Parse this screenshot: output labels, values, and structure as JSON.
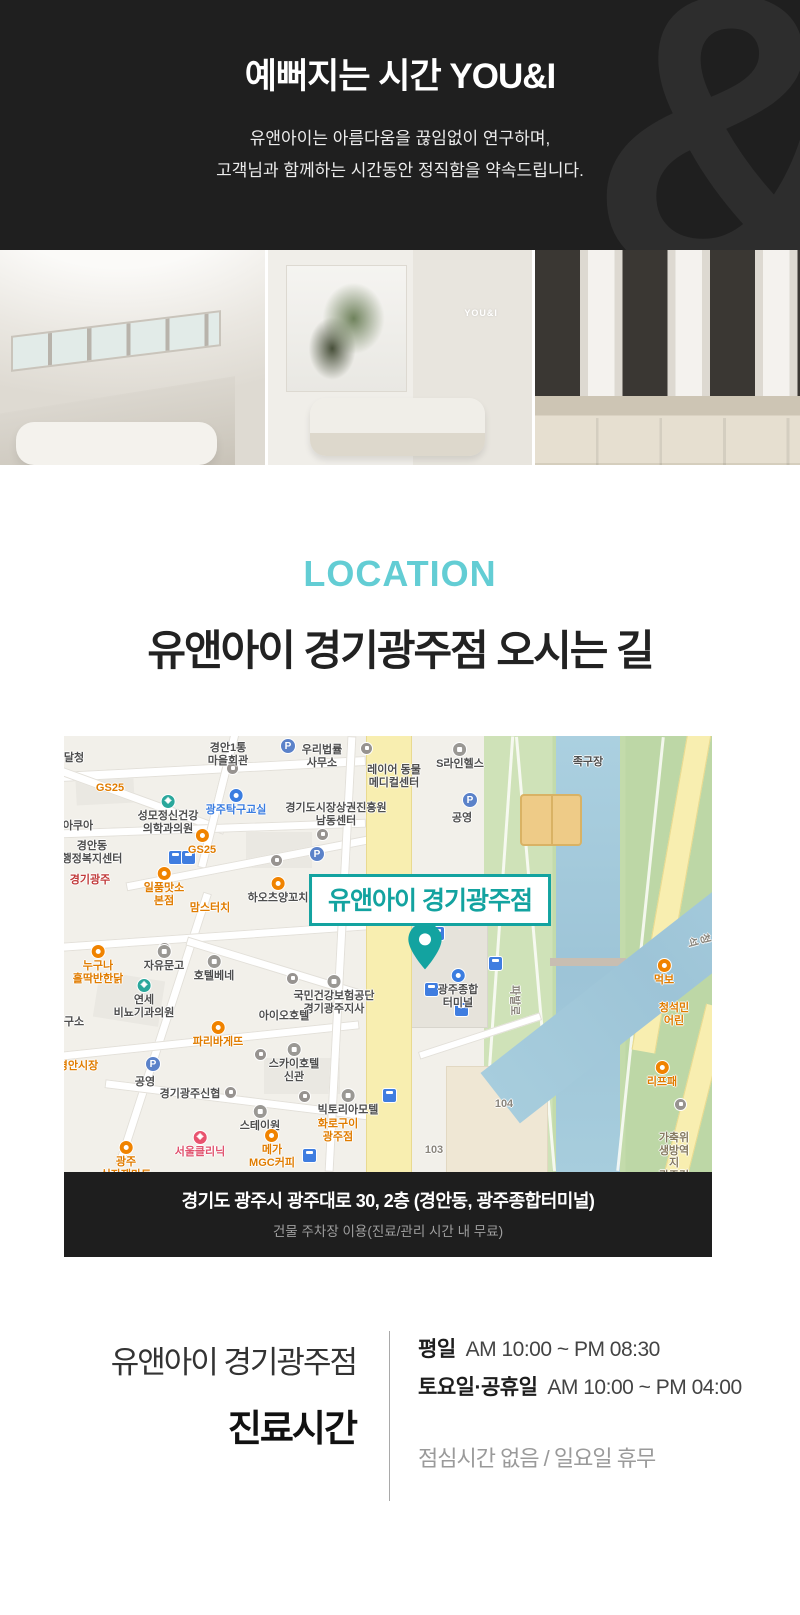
{
  "colors": {
    "accent_light": "#63cdd4",
    "accent_teal": "#13a3a0",
    "header_bg": "#1f1f1f",
    "bar_bg": "#1e1e1e"
  },
  "header": {
    "title": "예뻐지는 시간 YOU&I",
    "subtitle1": "유앤아이는 아름다움을 끊임없이 연구하며,",
    "subtitle2": "고객님과 함께하는 시간동안 정직함을 약속드립니다.",
    "watermark": "&"
  },
  "photos": {
    "sign": "YOU&I"
  },
  "location": {
    "eyebrow": "LOCATION",
    "heading": "유앤아이 경기광주점 오시는 길"
  },
  "map": {
    "callout": "유앤아이 경기광주점",
    "address": "경기도 광주시 광주대로 30, 2층 (경안동, 광주종합터미널)",
    "parking": "건물 주차장 이용(진료/관리 시간 내 무료)",
    "labels": [
      {
        "t": "달청",
        "x": 10,
        "y": 16,
        "c": "g"
      },
      {
        "t": "GS25",
        "x": 46,
        "y": 46,
        "c": "o"
      },
      {
        "t": "성모정신건강\n의학과의원",
        "x": 104,
        "y": 58,
        "c": "g",
        "ic": "h"
      },
      {
        "t": "아쿠아",
        "x": 14,
        "y": 84,
        "c": "g"
      },
      {
        "t": "경안동\n행정복지센터",
        "x": 28,
        "y": 104,
        "c": "g"
      },
      {
        "t": "경안1통\n마을회관",
        "x": 164,
        "y": 6,
        "c": "g"
      },
      {
        "t": "우리법률\n사무소",
        "x": 258,
        "y": 8,
        "c": "g"
      },
      {
        "t": "레이어 동물\n메디컬센터",
        "x": 330,
        "y": 28,
        "c": "g"
      },
      {
        "t": "S라인헬스",
        "x": 396,
        "y": 6,
        "c": "g",
        "ic": "d"
      },
      {
        "t": "광주탁구교실",
        "x": 172,
        "y": 52,
        "c": "b",
        "ic": "b"
      },
      {
        "t": "경기도시장상권진흥원\n남동센터",
        "x": 272,
        "y": 66,
        "c": "g"
      },
      {
        "t": "공영",
        "x": 398,
        "y": 76,
        "c": "g"
      },
      {
        "t": "족구장",
        "x": 524,
        "y": 20,
        "c": "g"
      },
      {
        "t": "경안천",
        "x": 608,
        "y": 10,
        "c": "river",
        "r": 52
      },
      {
        "t": "GS25",
        "x": 138,
        "y": 92,
        "c": "o",
        "ic": "o"
      },
      {
        "t": "일품맛소\n본점",
        "x": 100,
        "y": 130,
        "c": "o",
        "ic": "o"
      },
      {
        "t": "경기광주",
        "x": 26,
        "y": 138,
        "c": "r"
      },
      {
        "t": "하오츠양꼬치",
        "x": 214,
        "y": 140,
        "c": "g",
        "ic": "o"
      },
      {
        "t": "맘스터치",
        "x": 146,
        "y": 166,
        "c": "o"
      },
      {
        "t": "뚜레쥬르",
        "x": 270,
        "y": 162,
        "c": "o"
      },
      {
        "t": "이마",
        "x": 326,
        "y": 176,
        "c": "o"
      },
      {
        "t": "누구나\n홀딱반한닭",
        "x": 34,
        "y": 208,
        "c": "o",
        "ic": "o"
      },
      {
        "t": "자유문고",
        "x": 100,
        "y": 208,
        "c": "g",
        "ic": "d"
      },
      {
        "t": "호텔베네",
        "x": 150,
        "y": 218,
        "c": "g",
        "ic": "d"
      },
      {
        "t": "연세\n비뇨기과의원",
        "x": 80,
        "y": 242,
        "c": "g",
        "ic": "h"
      },
      {
        "t": "국민건강보험공단\n경기광주지사",
        "x": 270,
        "y": 238,
        "c": "g",
        "ic": "d"
      },
      {
        "t": "아이오호텔",
        "x": 220,
        "y": 274,
        "c": "g"
      },
      {
        "t": "파리바게뜨",
        "x": 154,
        "y": 284,
        "c": "o",
        "ic": "o"
      },
      {
        "t": "구소",
        "x": 10,
        "y": 280,
        "c": "g"
      },
      {
        "t": "경안시장",
        "x": 14,
        "y": 324,
        "c": "o"
      },
      {
        "t": "공영",
        "x": 81,
        "y": 340,
        "c": "g"
      },
      {
        "t": "스카이호텔\n신관",
        "x": 230,
        "y": 306,
        "c": "g",
        "ic": "d"
      },
      {
        "t": "경기광주신협",
        "x": 126,
        "y": 352,
        "c": "g"
      },
      {
        "t": "스테이원",
        "x": 196,
        "y": 368,
        "c": "g",
        "ic": "d"
      },
      {
        "t": "빅토리아모텔",
        "x": 284,
        "y": 352,
        "c": "g",
        "ic": "d"
      },
      {
        "t": "서울클리닉",
        "x": 136,
        "y": 394,
        "c": "pink",
        "ic": "x"
      },
      {
        "t": "메가\nMGC커피",
        "x": 208,
        "y": 392,
        "c": "o",
        "ic": "o"
      },
      {
        "t": "화로구이\n광주점",
        "x": 274,
        "y": 382,
        "c": "o"
      },
      {
        "t": "광주\n식자재마트",
        "x": 62,
        "y": 404,
        "c": "o",
        "ic": "o"
      },
      {
        "t": "103",
        "x": 370,
        "y": 408,
        "c": "rd"
      },
      {
        "t": "104",
        "x": 440,
        "y": 362,
        "c": "rd"
      },
      {
        "t": "광주종합\n터미널",
        "x": 394,
        "y": 232,
        "c": "g",
        "ic": "b"
      },
      {
        "t": "파발로",
        "x": 450,
        "y": 258,
        "c": "rd",
        "r": 90
      },
      {
        "t": "먹보",
        "x": 600,
        "y": 222,
        "c": "o",
        "ic": "o"
      },
      {
        "t": "청석민\n어린",
        "x": 610,
        "y": 266,
        "c": "o"
      },
      {
        "t": "리프패",
        "x": 598,
        "y": 324,
        "c": "o",
        "ic": "o"
      },
      {
        "t": "가축위생방역지\n광주검역사두",
        "x": 610,
        "y": 396,
        "c": "brown"
      },
      {
        "t": "청석",
        "x": 634,
        "y": 192,
        "c": "rd",
        "r": 75
      }
    ],
    "buses": [
      [
        104,
        114
      ],
      [
        117,
        114
      ],
      [
        366,
        190
      ],
      [
        360,
        246
      ],
      [
        390,
        266
      ],
      [
        318,
        352
      ],
      [
        238,
        412
      ],
      [
        424,
        220
      ]
    ],
    "parkings": [
      [
        216,
        2
      ],
      [
        398,
        56
      ],
      [
        81,
        320
      ],
      [
        245,
        110
      ]
    ],
    "dots": [
      [
        296,
        6
      ],
      [
        162,
        26
      ],
      [
        252,
        92
      ],
      [
        206,
        118
      ],
      [
        94,
        206
      ],
      [
        222,
        236
      ],
      [
        190,
        312
      ],
      [
        234,
        354
      ],
      [
        160,
        350
      ],
      [
        610,
        362
      ]
    ]
  },
  "hours": {
    "store": "유앤아이 경기광주점",
    "title": "진료시간",
    "rows": [
      {
        "label": "평일",
        "time": "AM 10:00 ~ PM 08:30"
      },
      {
        "label": "토요일·공휴일",
        "time": "AM 10:00 ~ PM 04:00"
      }
    ],
    "note": "점심시간 없음 / 일요일 휴무"
  }
}
